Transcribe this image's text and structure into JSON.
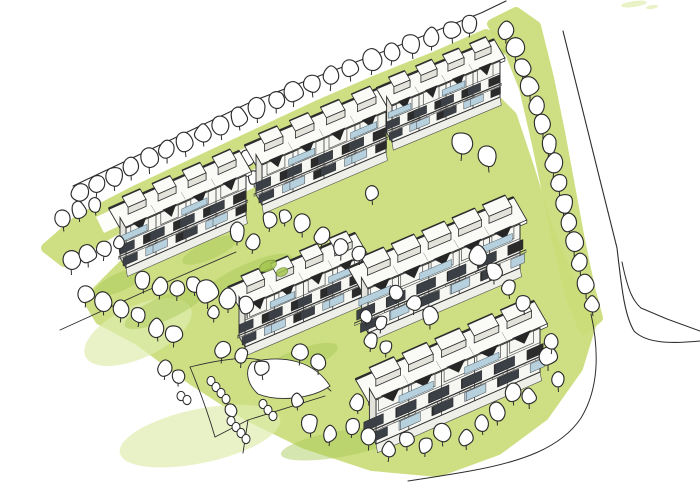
{
  "meta": {
    "type": "hand-drawn architectural site sketch",
    "description": "Aerial marker-and-ink sketch of a residential site: six terraced apartment blocks in two rows, lawns in yellow-green marker, rows of round deciduous trees, footpaths, and a curving road at the right edge",
    "canvas": {
      "width": 700,
      "height": 495
    }
  },
  "palette": {
    "paper": "#ffffff",
    "ink": "#2d2d2d",
    "ink_light": "#4a4a4a",
    "green": "#cadd79",
    "green_light": "#e0ecae",
    "green_dark": "#a5c751",
    "wall": "#f6f6f2",
    "wall_shade": "#e3e3dc",
    "roof": "#fafaf7",
    "glass": "#b7d0de",
    "window_dark": "#3a4046",
    "window_black": "#2b2b2b",
    "apron": "#efefea"
  },
  "scene": {
    "greens": [
      {
        "name": "green-strip-top-boundary",
        "pts": [
          [
            46,
            248
          ],
          [
            78,
            220
          ],
          [
            136,
            190
          ],
          [
            196,
            162
          ],
          [
            256,
            134
          ],
          [
            316,
            106
          ],
          [
            376,
            80
          ],
          [
            436,
            56
          ],
          [
            486,
            34
          ],
          [
            510,
            44
          ],
          [
            472,
            66
          ],
          [
            412,
            92
          ],
          [
            352,
            118
          ],
          [
            292,
            146
          ],
          [
            232,
            174
          ],
          [
            172,
            202
          ],
          [
            112,
            232
          ],
          [
            64,
            262
          ]
        ]
      },
      {
        "name": "green-strip-right-road",
        "pts": [
          [
            492,
            24
          ],
          [
            516,
            12
          ],
          [
            536,
            26
          ],
          [
            549,
            78
          ],
          [
            560,
            132
          ],
          [
            570,
            186
          ],
          [
            580,
            240
          ],
          [
            590,
            288
          ],
          [
            598,
            318
          ],
          [
            584,
            330
          ],
          [
            570,
            296
          ],
          [
            558,
            244
          ],
          [
            547,
            192
          ],
          [
            536,
            140
          ],
          [
            524,
            88
          ],
          [
            508,
            48
          ]
        ]
      },
      {
        "name": "green-central-lawn",
        "pts": [
          [
            88,
            300
          ],
          [
            130,
            258
          ],
          [
            178,
            232
          ],
          [
            240,
            200
          ],
          [
            305,
            168
          ],
          [
            368,
            140
          ],
          [
            430,
            112
          ],
          [
            488,
            92
          ],
          [
            512,
            116
          ],
          [
            530,
            170
          ],
          [
            548,
            228
          ],
          [
            572,
            286
          ],
          [
            592,
            322
          ],
          [
            578,
            368
          ],
          [
            544,
            416
          ],
          [
            498,
            450
          ],
          [
            438,
            472
          ],
          [
            372,
            466
          ],
          [
            305,
            444
          ],
          [
            248,
            416
          ],
          [
            192,
            380
          ],
          [
            138,
            340
          ],
          [
            100,
            320
          ]
        ]
      }
    ],
    "light_washes": [
      {
        "name": "wash-bottom-left",
        "cx": 200,
        "cy": 436,
        "rx": 82,
        "ry": 27,
        "rot": -12
      },
      {
        "name": "wash-left",
        "cx": 138,
        "cy": 332,
        "rx": 58,
        "ry": 26,
        "rot": -25
      },
      {
        "name": "wash-top-right-dash-1",
        "cx": 634,
        "cy": 4,
        "rx": 13,
        "ry": 3,
        "rot": -8
      },
      {
        "name": "wash-top-right-dash-2",
        "cx": 652,
        "cy": 7,
        "rx": 6,
        "ry": 2,
        "rot": -8
      }
    ],
    "green_accents": [
      {
        "cx": 165,
        "cy": 308,
        "rx": 44,
        "ry": 12,
        "rot": -24
      },
      {
        "cx": 248,
        "cy": 276,
        "rx": 48,
        "ry": 12,
        "rot": -24
      },
      {
        "cx": 210,
        "cy": 250,
        "rx": 30,
        "ry": 9,
        "rot": -24
      },
      {
        "cx": 335,
        "cy": 284,
        "rx": 38,
        "ry": 11,
        "rot": -24
      },
      {
        "cx": 452,
        "cy": 250,
        "rx": 40,
        "ry": 13,
        "rot": -24
      },
      {
        "cx": 480,
        "cy": 62,
        "rx": 28,
        "ry": 9,
        "rot": -24
      },
      {
        "cx": 340,
        "cy": 444,
        "rx": 60,
        "ry": 13,
        "rot": -10
      },
      {
        "cx": 520,
        "cy": 334,
        "rx": 30,
        "ry": 9,
        "rot": -24
      },
      {
        "cx": 120,
        "cy": 282,
        "rx": 28,
        "ry": 9,
        "rot": -24
      },
      {
        "cx": 300,
        "cy": 360,
        "rx": 40,
        "ry": 11,
        "rot": -20
      }
    ],
    "road_band": {
      "name": "internal-access-road",
      "pts": [
        [
          96,
          217
        ],
        [
          236,
          152
        ],
        [
          372,
          92
        ],
        [
          490,
          42
        ],
        [
          498,
          58
        ],
        [
          380,
          108
        ],
        [
          244,
          168
        ],
        [
          104,
          233
        ]
      ]
    },
    "lines": [
      {
        "name": "site-boundary-top",
        "d": "M 73,186 L 253,101 L 390,49 L 481,13 L 506,1",
        "w": 1.1
      },
      {
        "name": "road-edge-outer",
        "d": "M 563,31 L 600,180 L 617,248 C 622,292 625,316 634,331 C 646,343 669,344 700,341",
        "w": 1.1
      },
      {
        "name": "road-edge-inner",
        "d": "M 622,262 C 628,291 633,301 641,308 L 667,319 L 700,331",
        "w": 1.0
      },
      {
        "name": "site-boundary-bottom",
        "d": "M 591,314 C 600,355 598,390 581,418 C 561,448 521,462 470,471 C 448,475 428,478 408,481",
        "w": 1.0
      },
      {
        "name": "footpath-front-row1",
        "d": "M 60,330 L 146,291 L 236,252",
        "w": 0.9
      },
      {
        "name": "footpath-a",
        "d": "M 190,367 C 230,357 256,356 268,363 C 299,370 318,379 331,391",
        "w": 0.9
      },
      {
        "name": "footpath-b",
        "d": "M 190,367 C 200,391 208,413 215,437",
        "w": 0.9
      },
      {
        "name": "footpath-c",
        "d": "M 215,437 L 248,420 L 325,396",
        "w": 0.9
      },
      {
        "name": "footpath-d",
        "d": "M 248,420 L 243,453",
        "w": 0.9
      }
    ],
    "island": {
      "name": "lawn-island",
      "d": "M 252,362 C 285,354 315,362 330,386 C 312,399 278,402 258,394 C 246,383 245,369 252,362 Z"
    },
    "buildings": [
      {
        "name": "building-a",
        "base": [
          [
            126,
            268
          ],
          [
            246,
            215
          ]
        ],
        "h": 40,
        "units": 4
      },
      {
        "name": "building-b",
        "base": [
          [
            262,
            205
          ],
          [
            386,
            152
          ]
        ],
        "h": 40,
        "units": 4
      },
      {
        "name": "building-c",
        "base": [
          [
            392,
            142
          ],
          [
            500,
            97
          ]
        ],
        "h": 36,
        "units": 4
      },
      {
        "name": "building-d",
        "base": [
          [
            245,
            347
          ],
          [
            362,
            297
          ]
        ],
        "h": 40,
        "units": 4
      },
      {
        "name": "building-e",
        "base": [
          [
            368,
            333
          ],
          [
            520,
            268
          ]
        ],
        "h": 44,
        "units": 5
      },
      {
        "name": "building-f",
        "base": [
          [
            376,
            444
          ],
          [
            540,
            372
          ]
        ],
        "h": 44,
        "units": 5
      }
    ],
    "trees_back": [
      [
        80,
        193,
        10
      ],
      [
        97,
        184,
        9
      ],
      [
        114,
        176,
        10
      ],
      [
        131,
        167,
        9
      ],
      [
        149,
        159,
        10
      ],
      [
        167,
        150,
        9
      ],
      [
        185,
        142,
        10
      ],
      [
        203,
        133,
        9
      ],
      [
        221,
        125,
        10
      ],
      [
        239,
        117,
        9
      ],
      [
        257,
        108,
        10
      ],
      [
        276,
        100,
        9
      ],
      [
        294,
        92,
        10
      ],
      [
        312,
        84,
        9
      ],
      [
        331,
        76,
        10
      ],
      [
        350,
        68,
        9
      ],
      [
        372,
        60,
        10
      ],
      [
        392,
        52,
        9
      ],
      [
        412,
        44,
        10
      ],
      [
        432,
        37,
        9
      ],
      [
        452,
        30,
        9
      ],
      [
        470,
        24,
        9
      ],
      [
        506,
        30,
        9
      ],
      [
        515,
        48,
        10
      ],
      [
        523,
        67,
        9
      ],
      [
        530,
        86,
        10
      ],
      [
        537,
        105,
        9
      ],
      [
        543,
        124,
        10
      ],
      [
        549,
        144,
        9
      ],
      [
        554,
        163,
        10
      ],
      [
        248,
        158,
        8
      ],
      [
        254,
        177,
        7
      ],
      [
        376,
        124,
        8
      ],
      [
        366,
        141,
        7
      ],
      [
        372,
        193,
        8
      ]
    ],
    "trees_front": [
      [
        559,
        183,
        9
      ],
      [
        564,
        203,
        10
      ],
      [
        569,
        223,
        9
      ],
      [
        574,
        243,
        10
      ],
      [
        580,
        263,
        9
      ],
      [
        586,
        284,
        10
      ],
      [
        592,
        304,
        8
      ],
      [
        63,
        218,
        9
      ],
      [
        79,
        210,
        8
      ],
      [
        95,
        205,
        7
      ],
      [
        71,
        260,
        10
      ],
      [
        88,
        254,
        9
      ],
      [
        104,
        249,
        8
      ],
      [
        119,
        243,
        7
      ],
      [
        86,
        294,
        9
      ],
      [
        103,
        302,
        9
      ],
      [
        121,
        309,
        9
      ],
      [
        139,
        315,
        8
      ],
      [
        157,
        328,
        9
      ],
      [
        174,
        334,
        9
      ],
      [
        143,
        280,
        9
      ],
      [
        160,
        286,
        9
      ],
      [
        177,
        289,
        8
      ],
      [
        194,
        284,
        8
      ],
      [
        208,
        291,
        12
      ],
      [
        228,
        298,
        10
      ],
      [
        247,
        305,
        9
      ],
      [
        237,
        232,
        9
      ],
      [
        253,
        242,
        8
      ],
      [
        270,
        220,
        8
      ],
      [
        285,
        216,
        7
      ],
      [
        302,
        224,
        9
      ],
      [
        322,
        236,
        9
      ],
      [
        341,
        247,
        9
      ],
      [
        359,
        253,
        8
      ],
      [
        462,
        143,
        12
      ],
      [
        488,
        156,
        11
      ],
      [
        222,
        350,
        9
      ],
      [
        241,
        356,
        8
      ],
      [
        262,
        368,
        8
      ],
      [
        300,
        352,
        9
      ],
      [
        318,
        363,
        8
      ],
      [
        214,
        312,
        7
      ],
      [
        478,
        256,
        10
      ],
      [
        494,
        271,
        9
      ],
      [
        509,
        287,
        8
      ],
      [
        524,
        303,
        8
      ],
      [
        430,
        316,
        9
      ],
      [
        414,
        303,
        8
      ],
      [
        396,
        292,
        8
      ],
      [
        381,
        323,
        7
      ],
      [
        366,
        316,
        7
      ],
      [
        371,
        340,
        8
      ],
      [
        386,
        347,
        7
      ],
      [
        357,
        402,
        8
      ],
      [
        369,
        437,
        9
      ],
      [
        389,
        450,
        8
      ],
      [
        407,
        439,
        8
      ],
      [
        425,
        445,
        8
      ],
      [
        442,
        433,
        9
      ],
      [
        548,
        356,
        10
      ],
      [
        558,
        380,
        8
      ],
      [
        552,
        342,
        8
      ],
      [
        513,
        392,
        9
      ],
      [
        529,
        397,
        8
      ],
      [
        497,
        412,
        9
      ],
      [
        482,
        423,
        8
      ],
      [
        466,
        438,
        8
      ],
      [
        165,
        368,
        8
      ],
      [
        178,
        376,
        7
      ],
      [
        231,
        410,
        7
      ],
      [
        297,
        400,
        7
      ],
      [
        310,
        424,
        9
      ],
      [
        330,
        434,
        8
      ],
      [
        352,
        426,
        8
      ]
    ],
    "shrubs": [
      [
        211,
        381
      ],
      [
        216,
        387
      ],
      [
        221,
        393
      ],
      [
        226,
        399
      ],
      [
        231,
        421
      ],
      [
        236,
        427
      ],
      [
        241,
        433
      ],
      [
        246,
        439
      ],
      [
        263,
        404
      ],
      [
        268,
        410
      ],
      [
        273,
        416
      ],
      [
        181,
        396
      ],
      [
        187,
        400
      ]
    ],
    "hedges": [
      {
        "cx": 268,
        "cy": 266,
        "rx": 9,
        "ry": 5,
        "rot": -24
      },
      {
        "cx": 282,
        "cy": 272,
        "rx": 6,
        "ry": 4,
        "rot": -24
      }
    ]
  }
}
